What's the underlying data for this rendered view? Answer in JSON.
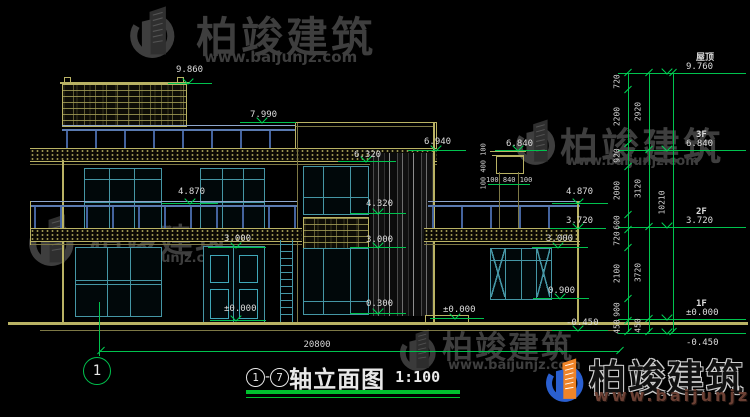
{
  "watermark": {
    "brand": "柏竣建筑",
    "url": "www.baijunjz.com"
  },
  "title": {
    "axis_start": "1",
    "axis_end": "7",
    "dash": "-",
    "name": "轴立面图",
    "scale": "1:100"
  },
  "axis_bubbles": {
    "bottom_left": "1"
  },
  "dimensions": {
    "overall_width": "20800",
    "chimney_vertical": "100 400 100",
    "chimney_horizontal": "100 840 100"
  },
  "drawing_levels": [
    "9.860",
    "7.990",
    "6.940",
    "6.320",
    "4.870",
    "4.320",
    "3.000",
    "±0.000",
    "0.300",
    "3.000",
    "4.870",
    "3.720",
    "3.000",
    "0.900",
    "±0.000",
    "-0.450",
    "6.840"
  ],
  "elevation_column": {
    "floors": [
      {
        "name": "屋顶",
        "elev": "9.760"
      },
      {
        "name": "3F",
        "elev": "6.840"
      },
      {
        "name": "2F",
        "elev": "3.720"
      },
      {
        "name": "1F",
        "elev": "±0.000"
      },
      {
        "name": "",
        "elev": "-0.450"
      }
    ],
    "chains": [
      [
        "720",
        "2200",
        "920",
        "2000",
        "600",
        "720",
        "2100",
        "900",
        "450"
      ],
      [
        "2920",
        "3120",
        "3720",
        "450"
      ],
      [
        "10210"
      ]
    ]
  },
  "colors": {
    "background": "#000000",
    "wall_yellow": "#b9b264",
    "window_teal": "#4596a5",
    "railing_blue": "#5a7ab0",
    "dim_green": "#00c24e",
    "text_white": "#dcdcdc",
    "watermark_gray": "#3e3e3e",
    "logo_blue": "#2a5fd0",
    "logo_orange": "#f08428",
    "logo_url_brown": "#6b4034"
  }
}
